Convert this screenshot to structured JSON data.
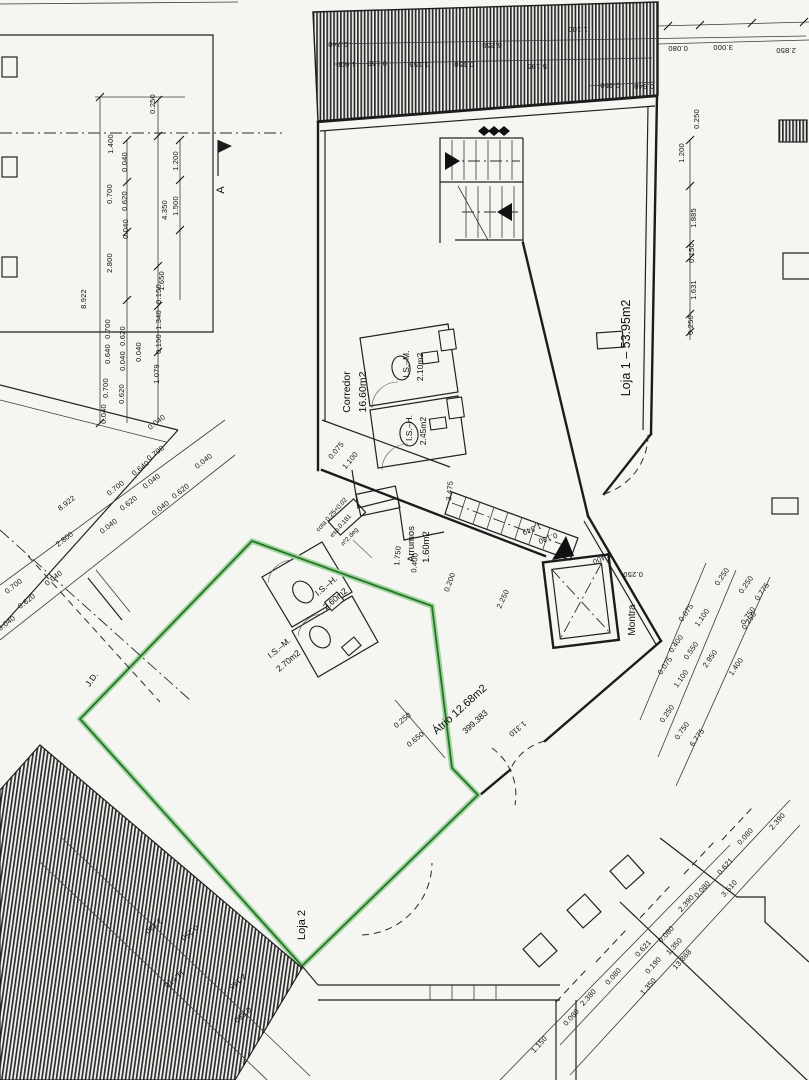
{
  "drawing": {
    "type": "architectural floor plan (scanned)",
    "accent_green": "#267326",
    "accent_green_light": "#9fd49f",
    "ink": "#1c1c1c"
  },
  "rooms": {
    "loja1": {
      "label": "Loja 1  –  53.95m2"
    },
    "corredor": {
      "name": "Corredor",
      "area": "16.60m2"
    },
    "is_m_top": {
      "name": "I.S.–M.",
      "area": "2.10m2"
    },
    "is_h_top": {
      "name": "I.S.–H.",
      "area": "2.45m2"
    },
    "arrumos": {
      "name": "Arrumos",
      "area": "1.60m2"
    },
    "is_h_left": {
      "name": "I.S.–H.",
      "area": "2.60m2"
    },
    "is_m_left": {
      "name": "I.S.–M.",
      "area": "2.70m2"
    },
    "atrio": {
      "label": "Átrio 12.68m2",
      "elevation": "399.383"
    },
    "loja2": {
      "label": "Loja 2"
    },
    "montra": {
      "label": "Montra"
    },
    "jd": {
      "label": "J.D."
    }
  },
  "section_marker": {
    "label": "A"
  },
  "notes": {
    "line1": "cota 0.25+0.02",
    "line2": "esp.0.181",
    "line3": "nº2.deg"
  },
  "dims": {
    "top_band": [
      "0.740",
      "6.250",
      "1.100",
      "1.600",
      "0.150",
      "1.155",
      "0.150",
      "5.195",
      "0.650",
      "0.940"
    ],
    "top_right": [
      "0.080",
      "3.000",
      "2.850"
    ],
    "right_col": [
      "0.250",
      "1.200",
      "1.885",
      "0.150",
      "1.631",
      "0.250"
    ],
    "left_col": [
      "0.250",
      "1.400",
      "0.040",
      "0.700",
      "0.620",
      "0.040",
      "2.800",
      "8.922",
      "1.200",
      "1.500",
      "4.350",
      "1.650",
      "0.150",
      "1.340",
      "0.150",
      "1.079",
      "0.700",
      "0.620",
      "0.640",
      "0.040",
      "0.040",
      "0.700",
      "0.620",
      "0.040"
    ],
    "left_diag": [
      "8.922",
      "2.800",
      "0.040",
      "0.700",
      "0.620",
      "0.640",
      "0.040",
      "0.700",
      "0.040",
      "0.620",
      "0.040",
      "0.040",
      "0.700",
      "0.620",
      "0.040",
      "0.040"
    ],
    "mid": [
      "0.075",
      "1.100",
      "3.475",
      "1.750",
      "0.400",
      "0.200",
      "2.250",
      "1.349",
      "0.130",
      "1.400",
      "0.250"
    ],
    "atrio": [
      "0.250",
      "0.650",
      "1.310"
    ],
    "right_diag": [
      "0.250",
      "0.250",
      "0.775",
      "0.075",
      "1.100",
      "0.750",
      "0.400",
      "0.550",
      "2.950",
      "1.400",
      "0.075",
      "1.100",
      "0.250",
      "0.750",
      "6.775",
      "0.250"
    ],
    "bottom_right": [
      "1.150",
      "0.080",
      "2.380",
      "0.080",
      "0.621",
      "0.080",
      "2.390",
      "0.080",
      "0.621",
      "0.080",
      "2.390",
      "1.350",
      "0.190",
      "1.350",
      "3.510",
      "13.868"
    ],
    "bottom_left": [
      "3.140",
      "0.250",
      "11.570",
      "2.145",
      "0.550"
    ]
  }
}
